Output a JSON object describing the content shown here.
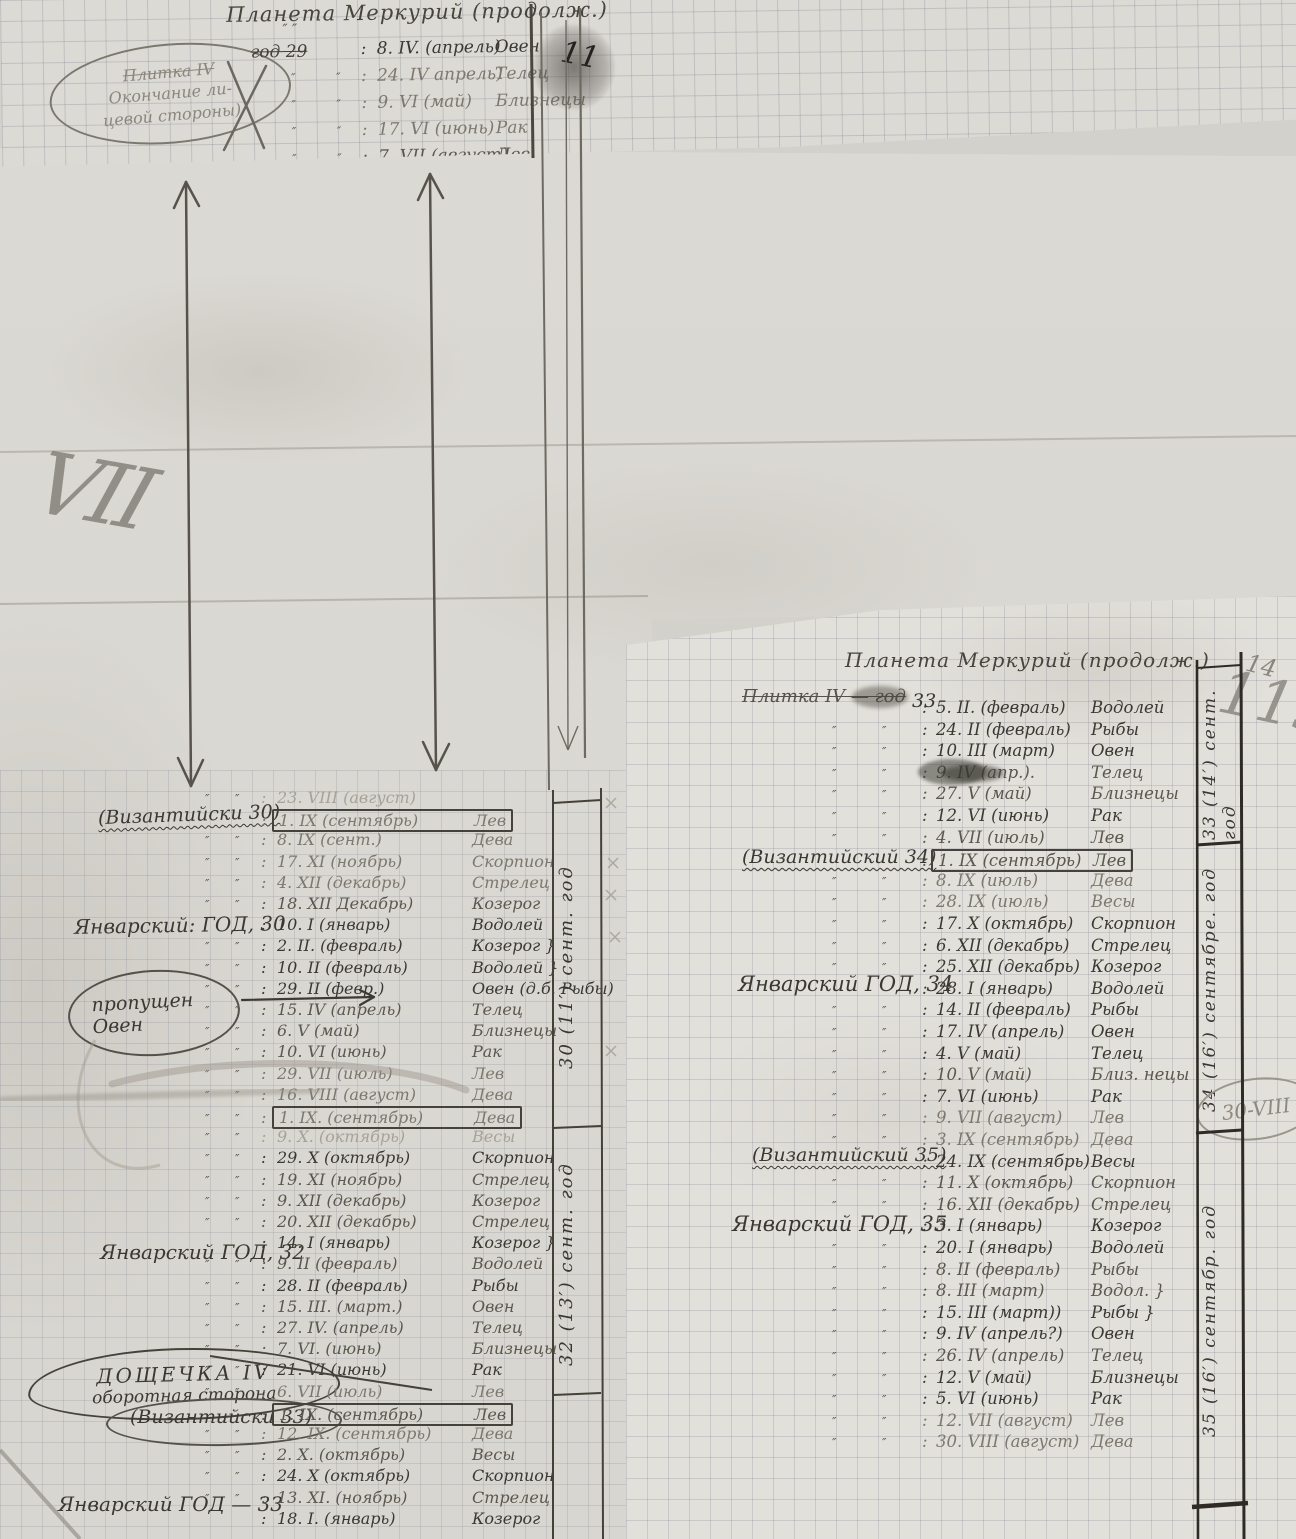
{
  "top": {
    "title": "Планета Меркурий (продолж.)",
    "ditto_over": "″  ″",
    "year_struck": "год 29",
    "oval_line1": "Плитка IV",
    "oval_line2": "Окончание ли-",
    "oval_line3": "цевой стороны)",
    "rows": [
      {
        "d": "8. IV. (апрель)",
        "s": "Овен",
        "nod": true
      },
      {
        "d": "24. IV апрель)",
        "s": "Телец",
        "t": "light"
      },
      {
        "d": "9. VI (май)",
        "s": "Близнецы",
        "t": "light"
      },
      {
        "d": "17. VI (июнь)",
        "s": "Рак",
        "t": "light"
      },
      {
        "d": "7. VII (август)",
        "s": "Лев",
        "t": "mid",
        "ul": true
      }
    ]
  },
  "left": {
    "labels": {
      "byz30": "(Византийски 30)",
      "jan30": "Январский: ГОД,  30",
      "missed1": "пропущен",
      "missed2": "Овен",
      "jan32": "Январский ГОД, 32",
      "tablet1": "ДОЩЕЧКА IV",
      "tablet2": "оборотная сторона",
      "byz33": "(Византийски 33)",
      "jan33": "Январский ГОД — 33",
      "margin30": "30 (11′) сент. год",
      "margin32": "32 (13′) сент. год",
      "mark_vii": "VII"
    },
    "rows": [
      {
        "d": "23. VIII (август)",
        "s": "",
        "t": "faint"
      },
      {
        "d": "1. IX (сентябрь)",
        "s": "Лев",
        "t": "light",
        "box": true,
        "nod": true
      },
      {
        "d": "8. IX (сент.)",
        "s": "Дева",
        "t": "light"
      },
      {
        "d": "17. XI (ноябрь)",
        "s": "Скорпион",
        "t": "light"
      },
      {
        "d": "4. XII (декабрь)",
        "s": "Стрелец",
        "t": "light"
      },
      {
        "d": "18. XII Декабрь)",
        "s": "Козерог",
        "t": "mid"
      },
      {
        "d": "10. I (январь)",
        "s": "Водолей",
        "nod": true
      },
      {
        "d": "2. II. (февраль)",
        "s": "Козерог }"
      },
      {
        "d": "10. II (февраль)",
        "s": "Водолей }"
      },
      {
        "d": "29. II (февр.)",
        "s": "Овен (д.б. Рыбы)"
      },
      {
        "d": "15. IV (апрель)",
        "s": "Телец",
        "t": "mid"
      },
      {
        "d": "6. V (май)",
        "s": "Близнецы",
        "t": "mid"
      },
      {
        "d": "10. VI (июнь)",
        "s": "Рак",
        "t": "mid"
      },
      {
        "d": "29. VII (июль)",
        "s": "Лев",
        "t": "light"
      },
      {
        "d": "16. VIII (август)",
        "s": "Дева",
        "t": "light"
      },
      {
        "d": "1. IX. (сентябрь)",
        "s": "Дева",
        "t": "light",
        "box": true
      },
      {
        "d": "9. X. (октябрь)",
        "s": "Весы",
        "t": "faint"
      },
      {
        "d": "29. X (октябрь)",
        "s": "Скорпион"
      },
      {
        "d": "19. XI (ноябрь)",
        "s": "Стрелец",
        "t": "mid"
      },
      {
        "d": "9. XII (декабрь)",
        "s": "Козерог",
        "t": "mid"
      },
      {
        "d": "20. XII (декабрь)",
        "s": "Стрелец",
        "t": "mid"
      },
      {
        "d": "14. I (январь)",
        "s": "Козерог }",
        "nod": true
      },
      {
        "d": "9. II (февраль)",
        "s": "Водолей",
        "t": "mid"
      },
      {
        "d": "28. II (февраль)",
        "s": "Рыбы"
      },
      {
        "d": "15. III. (март.)",
        "s": "Овен",
        "t": "mid"
      },
      {
        "d": "27. IV. (апрель)",
        "s": "Телец",
        "t": "mid"
      },
      {
        "d": "7. VI. (июнь)",
        "s": "Близнецы",
        "t": "mid"
      },
      {
        "d": "21. VI (июнь)",
        "s": "Рак"
      },
      {
        "d": "6. VII (июль)",
        "s": "Лев",
        "t": "light"
      },
      {
        "d": "1. IX. (сентябрь)",
        "s": "Лев",
        "t": "mid",
        "box": true,
        "nod": true
      },
      {
        "d": "12. IX. (сентябрь)",
        "s": "Дева",
        "t": "light"
      },
      {
        "d": "2. X. (октябрь)",
        "s": "Весы",
        "t": "mid"
      },
      {
        "d": "24. X (октябрь)",
        "s": "Скорпион"
      },
      {
        "d": "13. XI. (ноябрь)",
        "s": "Стрелец",
        "t": "mid"
      },
      {
        "d": "18. I. (январь)",
        "s": "Козерог",
        "nod": true
      }
    ]
  },
  "right": {
    "title": "Планета Меркурий (продолж.)",
    "labels": {
      "struck": "Плитка IV — год",
      "year33": "33",
      "byz34": "(Византийский 34)",
      "jan34": "Январский ГОД, 34",
      "byz35": "(Византийский 35)",
      "jan35": "Январский ГОД, 35",
      "margin33": "33 (14′) сент. год",
      "margin34": "34 (16′) сентябре. год",
      "margin35": "35 (16′) сентябр. год",
      "note_30viii": "30-VIII",
      "page_small": "14",
      "page_big": "119"
    },
    "rows": [
      {
        "d": "5. II. (февраль)",
        "s": "Водолей",
        "nod": true
      },
      {
        "d": "24. II (февраль)",
        "s": "Рыбы"
      },
      {
        "d": "10. III (март)",
        "s": "Овен"
      },
      {
        "d": "9. IV (апр.).",
        "s": "Телец",
        "t": "mid",
        "blot": true
      },
      {
        "d": "27. V (май)",
        "s": "Близнецы",
        "t": "mid"
      },
      {
        "d": "12. VI (июнь)",
        "s": "Рак"
      },
      {
        "d": "4. VII (июль)",
        "s": "Лев",
        "t": "mid"
      },
      {
        "d": "1. IX (сентябрь)",
        "s": "Лев",
        "t": "mid",
        "box": true,
        "nod": true
      },
      {
        "d": "8. IX (июль)",
        "s": "Дева",
        "t": "light"
      },
      {
        "d": "28. IX (июль)",
        "s": "Весы",
        "t": "light"
      },
      {
        "d": "17. X (октябрь)",
        "s": "Скорпион"
      },
      {
        "d": "6. XII (декабрь)",
        "s": "Стрелец"
      },
      {
        "d": "25. XII (декабрь)",
        "s": "Козерог"
      },
      {
        "d": "28. I (январь)",
        "s": "Водолей",
        "nod": true
      },
      {
        "d": "14. II (февраль)",
        "s": "Рыбы"
      },
      {
        "d": "17. IV (апрель)",
        "s": "Овен"
      },
      {
        "d": "4. V (май)",
        "s": "Телец"
      },
      {
        "d": "10. V (май)",
        "s": "Близ. нецы",
        "t": "mid"
      },
      {
        "d": "7. VI (июнь)",
        "s": "Рак"
      },
      {
        "d": "9. VII (август)",
        "s": "Лев",
        "t": "light"
      },
      {
        "d": "3. IX (сентябрь)",
        "s": "Дева",
        "t": "light"
      },
      {
        "d": "24. IX (сентябрь)",
        "s": "Весы",
        "nod": true
      },
      {
        "d": "11. X (октябрь)",
        "s": "Скорпион",
        "t": "mid"
      },
      {
        "d": "16. XII (декабрь)",
        "s": "Стрелец",
        "t": "mid"
      },
      {
        "d": "3. I (январь)",
        "s": "Козерог",
        "nod": true
      },
      {
        "d": "20. I (январь)",
        "s": "Водолей"
      },
      {
        "d": "8. II (февраль)",
        "s": "Рыбы",
        "t": "mid"
      },
      {
        "d": "8. III (март)",
        "s": "Водол. }",
        "t": "mid"
      },
      {
        "d": "15. III (март))",
        "s": "Рыбы }"
      },
      {
        "d": "9. IV (апрель?)",
        "s": "Овен"
      },
      {
        "d": "26. IV (апрель)",
        "s": "Телец",
        "t": "mid"
      },
      {
        "d": "12. V (май)",
        "s": "Близнецы"
      },
      {
        "d": "5. VI (июнь)",
        "s": "Рак"
      },
      {
        "d": "12. VII (август)",
        "s": "Лев",
        "t": "light"
      },
      {
        "d": "30. VIII (август)",
        "s": "Дева",
        "t": "light"
      }
    ]
  }
}
